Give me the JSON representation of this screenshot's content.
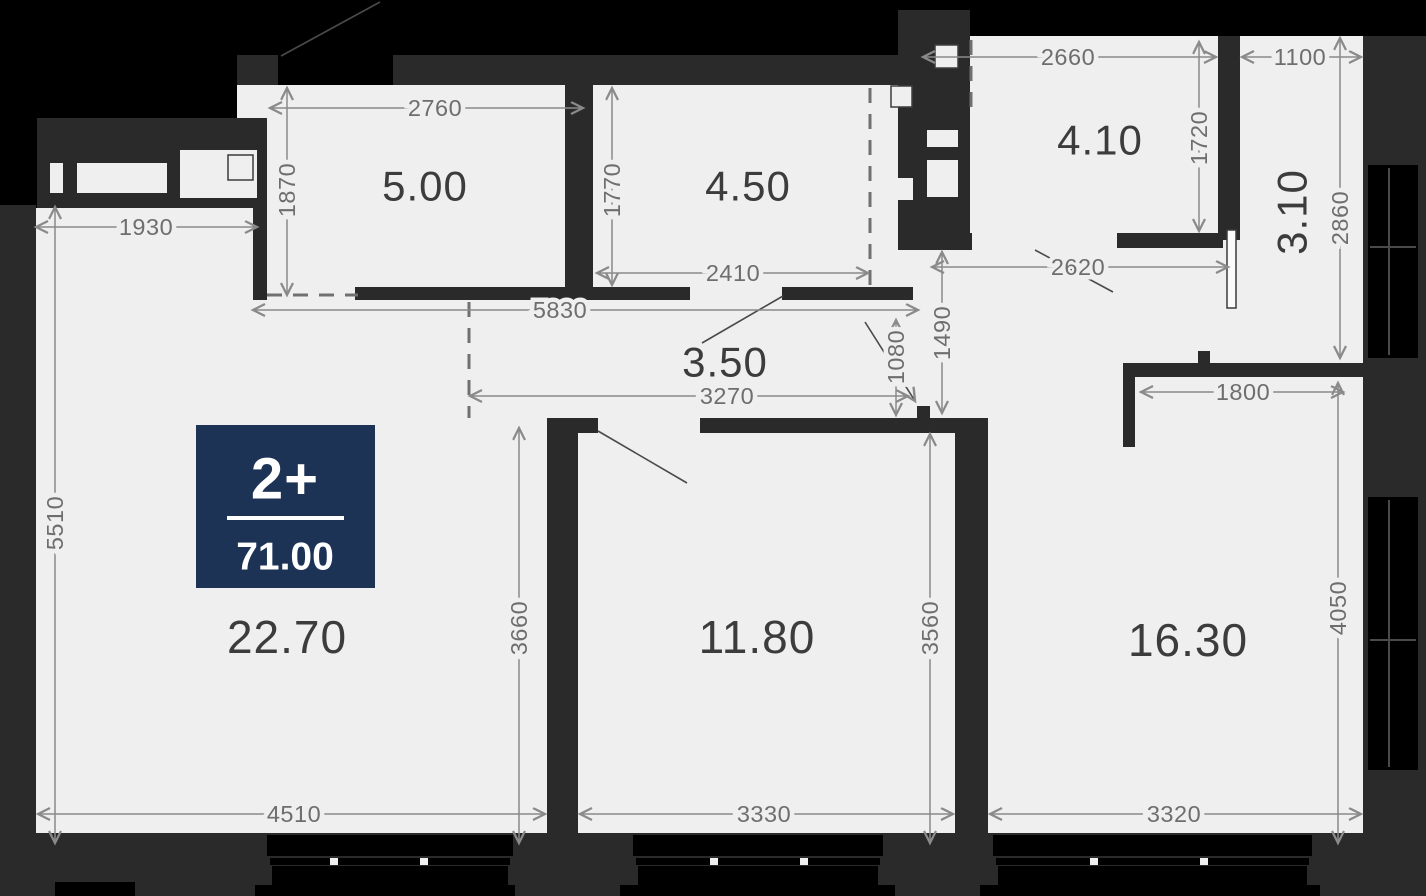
{
  "badge": {
    "type_label": "2+",
    "total_area": "71.00"
  },
  "rooms": [
    {
      "area": "5.00"
    },
    {
      "area": "4.50"
    },
    {
      "area": "4.10"
    },
    {
      "area": "3.10"
    },
    {
      "area": "3.50"
    },
    {
      "area": "22.70"
    },
    {
      "area": "11.80"
    },
    {
      "area": "16.30"
    }
  ],
  "dimensions": [
    "2760",
    "1870",
    "1930",
    "5510",
    "2410",
    "1770",
    "5830",
    "3270",
    "1080",
    "1490",
    "2620",
    "2660",
    "1720",
    "1100",
    "2860",
    "1800",
    "3660",
    "3560",
    "4050",
    "4510",
    "3330",
    "3320"
  ],
  "colors": {
    "floor": "#efefef",
    "outside": "#000000",
    "wall": "#2a2a2b",
    "dim_line": "#8a8a8a",
    "dim_text": "#6e6e6e",
    "room_text": "#3c3c3c",
    "badge": "#1c3356"
  }
}
